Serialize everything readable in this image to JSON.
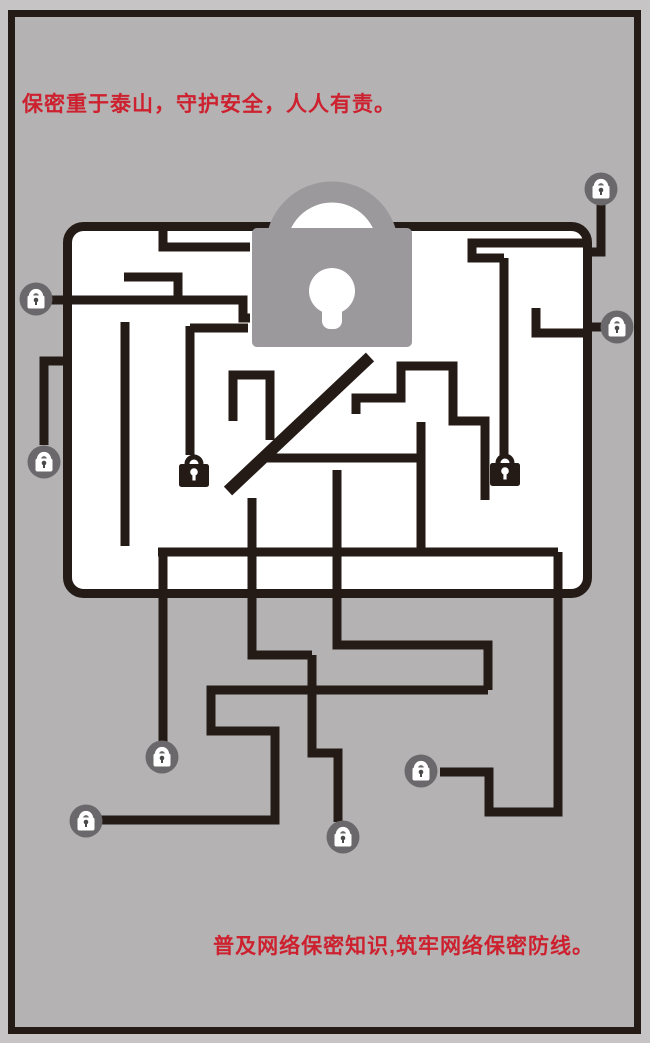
{
  "slogans": {
    "top": "保密重于泰山，守护安全，人人有责。",
    "bottom": "普及网络保密知识,筑牢网络保密防线。"
  },
  "colors": {
    "slogan_red": "#cd212f",
    "line_dark": "#241a16",
    "background_gray": "#b4b2b3",
    "outer_gray": "#c6c4c5",
    "big_lock_gray": "#9b999b",
    "badge_circle_gray": "#6a686a",
    "screen_white": "#ffffff"
  },
  "icons": {
    "big_lock": "padlock-icon",
    "badge_lock": "lock-badge-icon",
    "black_lock": "black-padlock-icon"
  },
  "counts": {
    "lock_badges": 8,
    "black_padlocks": 2
  }
}
